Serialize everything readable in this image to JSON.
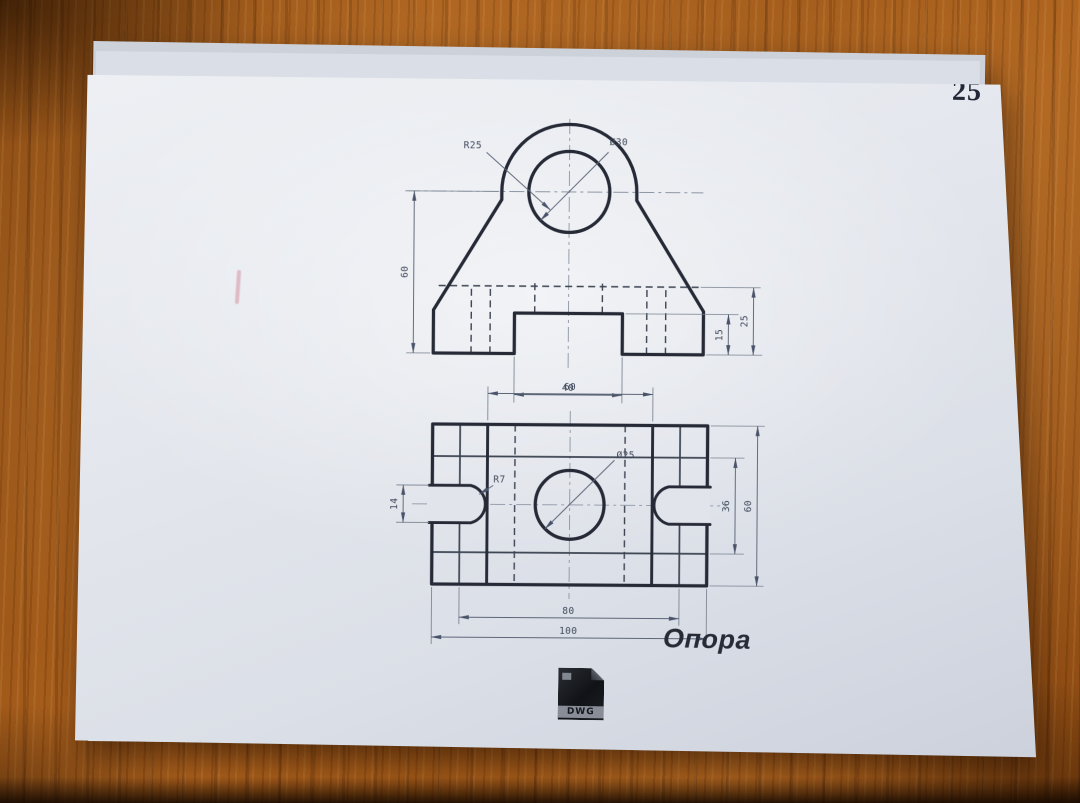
{
  "page": {
    "number": "25"
  },
  "drawing": {
    "title": "Опора",
    "front": {
      "radius": "R25",
      "hole": "Ø30",
      "height": "60",
      "notch_width": "40",
      "notch_depth": "15",
      "slot_depth": "25"
    },
    "plan": {
      "inner_width": "60",
      "slot_width": "14",
      "slot_radius": "R7",
      "hole": "Ø25",
      "inner_height": "36",
      "height": "60",
      "inner_length": "80",
      "length": "100"
    },
    "logo_text": "DWG"
  },
  "colors": {
    "paper": "#e4e7ed",
    "line": "#252a36",
    "wood": "#a85c18"
  }
}
